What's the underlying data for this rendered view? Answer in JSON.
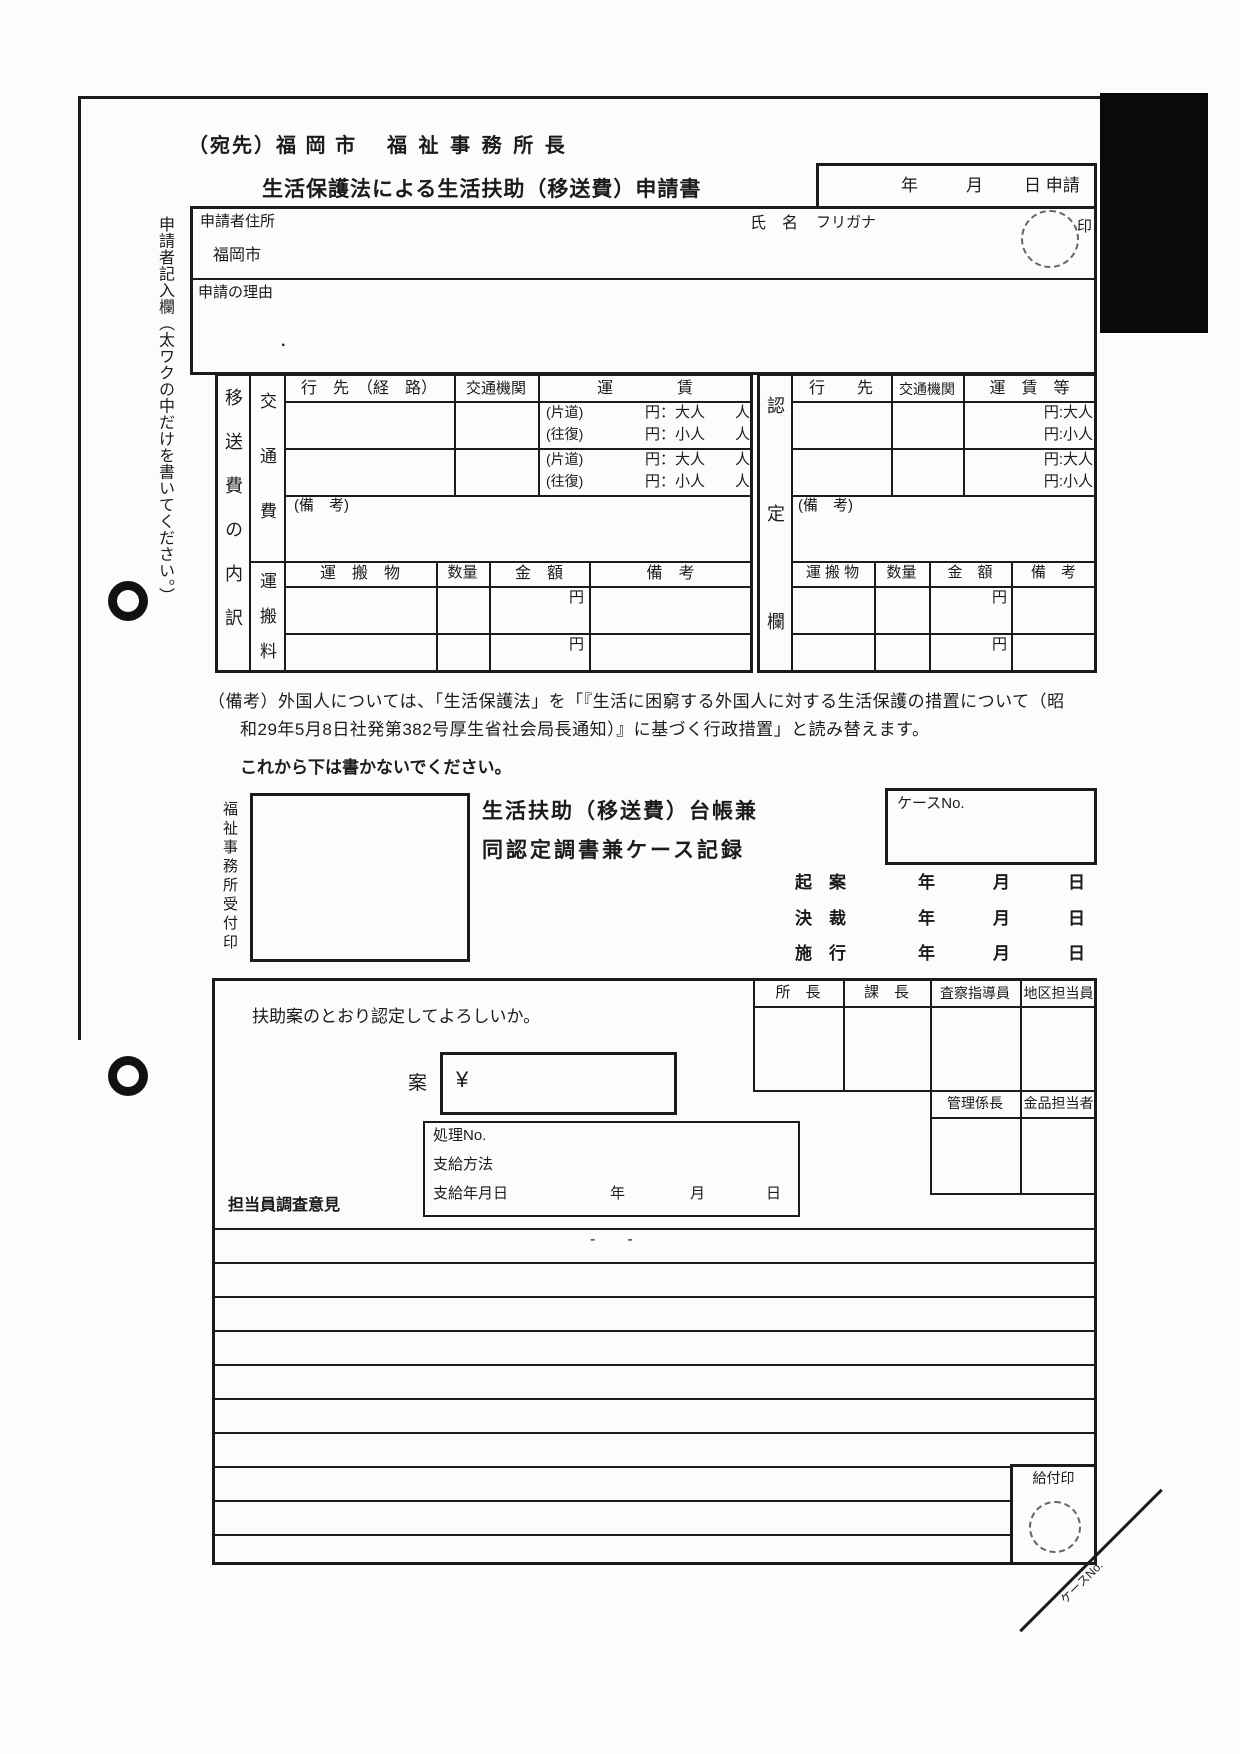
{
  "header": {
    "addressee_left": "（宛先）福 岡 市",
    "addressee_right": "福 祉 事 務 所 長",
    "title": "生活保護法による生活扶助（移送費）申請書",
    "date_year": "年",
    "date_month": "月",
    "date_day_apply": "日 申請"
  },
  "sidebar": {
    "note": "申請者記入欄（太ワクの中だけを書いてください。）"
  },
  "applicant": {
    "address_label": "申請者住所",
    "address_value": "福岡市",
    "name_label": "氏　名",
    "furigana_label": "フリガナ",
    "seal_label": "印",
    "reason_label": "申請の理由",
    "stray_mark": "."
  },
  "cost_table": {
    "side_label": "移送費の内訳",
    "transport_label": "交通費",
    "haulage_label": "運搬料",
    "destination_header": "行　先　（経　路）",
    "carrier_header": "交通機関",
    "fare_header": "運　　　　賃",
    "oneway": "(片道)",
    "roundtrip": "(往復)",
    "fare_adult": "円：大人　　人",
    "fare_child": "円：小人　　人",
    "remarks_label": "(備　考)",
    "goods_header": "運　搬　物",
    "qty_header": "数量",
    "amount_header": "金　額",
    "haul_remarks_header": "備　考",
    "yen": "円"
  },
  "cert_table": {
    "side_label": "認定欄",
    "destination_header": "行　　先",
    "carrier_header": "交通機関",
    "fare_header": "運　賃　等",
    "fare_adult": "円:大人",
    "fare_child": "円:小人",
    "remarks_label": "(備　考)",
    "goods_header": "運 搬 物",
    "qty_header": "数量",
    "amount_header": "金　額",
    "haul_remarks_header": "備　考",
    "yen": "円"
  },
  "footnote": {
    "line1": "（備考）外国人については、「生活保護法」を「『生活に困窮する外国人に対する生活保護の措置について（昭",
    "line2": "和29年5月8日社発第382号厚生省社会局長通知）』に基づく行政措置」と読み替えます。"
  },
  "notice": "これから下は書かないでください。",
  "office": {
    "receipt_stamp_label": "福祉事務所受付印",
    "ledger_title_line1": "生活扶助（移送費）台帳兼",
    "ledger_title_line2": "同認定調書兼ケース記録",
    "case_no_label": "ケースNo.",
    "draft_label": "起　案",
    "decision_label": "決　裁",
    "enforce_label": "施　行",
    "year": "年",
    "month": "月",
    "day": "日"
  },
  "bottom": {
    "question": "扶助案のとおり認定してよろしいか。",
    "plan_label": "案",
    "yen_sign": "¥",
    "process_no_label": "処理No.",
    "pay_method_label": "支給方法",
    "pay_date_label": "支給年月日",
    "year": "年",
    "month": "月",
    "day": "日",
    "opinion_label": "担当員調査意見",
    "chief_label": "所　長",
    "section_chief_label": "課　長",
    "inspector_label": "査察指導員",
    "district_officer_label": "地区担当員",
    "admin_chief_label": "管理係長",
    "goods_officer_label": "金品担当者",
    "dashes": "-　　-",
    "benefit_stamp_label": "給付印",
    "corner_case_no": "ケースNo."
  }
}
